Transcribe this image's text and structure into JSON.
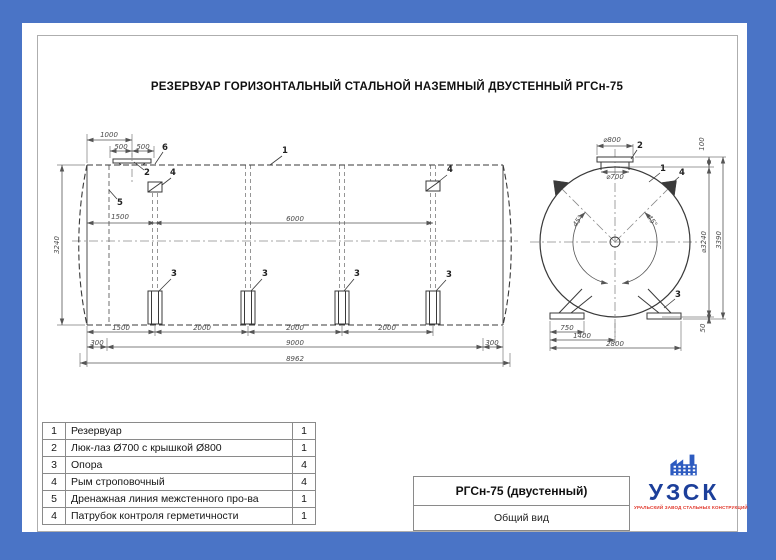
{
  "page": {
    "title": "РЕЗЕРВУАР ГОРИЗОНТАЛЬНЫЙ СТАЛЬНОЙ НАЗЕМНЫЙ ДВУСТЕННЫЙ РГСн-75"
  },
  "colors": {
    "border_blue": "#4a74c6",
    "logo_navy": "#1c3f9a",
    "logo_red": "#e03226",
    "line_dark": "#3a3a3a",
    "dim_gray": "#555555"
  },
  "parts_table": {
    "rows": [
      {
        "no": "1",
        "name": "Резервуар",
        "qty": "1"
      },
      {
        "no": "2",
        "name": "Люк-лаз Ø700 с крышкой Ø800",
        "qty": "1"
      },
      {
        "no": "3",
        "name": "Опора",
        "qty": "4"
      },
      {
        "no": "4",
        "name": "Рым строповочный",
        "qty": "4"
      },
      {
        "no": "5",
        "name": "Дренажная линия межстенного про-ва",
        "qty": "1"
      },
      {
        "no": "4",
        "name": "Патрубок контроля герметичности",
        "qty": "1"
      }
    ]
  },
  "title_block": {
    "model": "РГСн-75 (двустенный)",
    "view": "Общий вид"
  },
  "logo": {
    "name": "УЗСК",
    "tagline": "УРАЛЬСКИЙ ЗАВОД СТАЛЬНЫХ КОНСТРУКЦИЙ"
  },
  "drawing": {
    "labels": [
      {
        "t": "1000",
        "x": 87,
        "y": 112,
        "n": "dim-1000"
      },
      {
        "t": "500",
        "x": 99,
        "y": 124,
        "n": "dim-500-left"
      },
      {
        "t": "500",
        "x": 121,
        "y": 124,
        "n": "dim-500-right"
      },
      {
        "t": "1500",
        "x": 98,
        "y": 194,
        "n": "dim-1500-top"
      },
      {
        "t": "6000",
        "x": 273,
        "y": 196,
        "n": "dim-6000"
      },
      {
        "t": "3240",
        "x": 35,
        "y": 222,
        "r": -90,
        "n": "dim-3240-height"
      },
      {
        "t": "1500",
        "x": 99,
        "y": 305,
        "n": "dim-1500-bottom"
      },
      {
        "t": "2000",
        "x": 180,
        "y": 305,
        "n": "dim-2000-1"
      },
      {
        "t": "2000",
        "x": 273,
        "y": 305,
        "n": "dim-2000-2"
      },
      {
        "t": "2000",
        "x": 365,
        "y": 305,
        "n": "dim-2000-3"
      },
      {
        "t": "300",
        "x": 75,
        "y": 320,
        "n": "dim-300-left"
      },
      {
        "t": "9000",
        "x": 273,
        "y": 320,
        "n": "dim-9000"
      },
      {
        "t": "300",
        "x": 470,
        "y": 320,
        "n": "dim-300-right"
      },
      {
        "t": "8962",
        "x": 273,
        "y": 336,
        "n": "dim-8962"
      },
      {
        "t": "1",
        "x": 263,
        "y": 128,
        "c": 1,
        "n": "callout-1-shell"
      },
      {
        "t": "2",
        "x": 125,
        "y": 150,
        "c": 1,
        "n": "callout-2-manhole"
      },
      {
        "t": "6",
        "x": 143,
        "y": 125,
        "c": 1,
        "n": "callout-6-nozzle"
      },
      {
        "t": "4",
        "x": 151,
        "y": 150,
        "c": 1,
        "n": "callout-4-fitting-left"
      },
      {
        "t": "4",
        "x": 428,
        "y": 147,
        "c": 1,
        "n": "callout-4-fitting-right"
      },
      {
        "t": "5",
        "x": 98,
        "y": 180,
        "c": 1,
        "n": "callout-5-drain-line"
      },
      {
        "t": "3",
        "x": 152,
        "y": 251,
        "c": 1,
        "n": "callout-3-support-1"
      },
      {
        "t": "3",
        "x": 243,
        "y": 251,
        "c": 1,
        "n": "callout-3-support-2"
      },
      {
        "t": "3",
        "x": 335,
        "y": 251,
        "c": 1,
        "n": "callout-3-support-3"
      },
      {
        "t": "3",
        "x": 427,
        "y": 252,
        "c": 1,
        "n": "callout-3-support-4"
      },
      {
        "t": "⌀800",
        "x": 590,
        "y": 117,
        "n": "dim-d800"
      },
      {
        "t": "⌀700",
        "x": 593,
        "y": 154,
        "n": "dim-d700"
      },
      {
        "t": "100",
        "x": 680,
        "y": 121,
        "r": -90,
        "n": "dim-100"
      },
      {
        "t": "⌀3240",
        "x": 682,
        "y": 219,
        "r": -90,
        "n": "dim-d3240"
      },
      {
        "t": "3390",
        "x": 697,
        "y": 217,
        "r": -90,
        "n": "dim-3390"
      },
      {
        "t": "50",
        "x": 681,
        "y": 305,
        "r": -90,
        "n": "dim-50"
      },
      {
        "t": "45°",
        "x": 556,
        "y": 198,
        "r": -55,
        "n": "dim-45-left"
      },
      {
        "t": "45°",
        "x": 630,
        "y": 198,
        "r": 55,
        "n": "dim-45-right"
      },
      {
        "t": "750",
        "x": 545,
        "y": 305,
        "n": "dim-750"
      },
      {
        "t": "1400",
        "x": 560,
        "y": 313,
        "n": "dim-1400"
      },
      {
        "t": "2800",
        "x": 593,
        "y": 321,
        "n": "dim-2800"
      },
      {
        "t": "2",
        "x": 618,
        "y": 123,
        "c": 1,
        "n": "callout-2-end-cover"
      },
      {
        "t": "1",
        "x": 641,
        "y": 146,
        "c": 1,
        "n": "callout-1-end-shell"
      },
      {
        "t": "4",
        "x": 660,
        "y": 150,
        "c": 1,
        "n": "callout-4-end-lug"
      },
      {
        "t": "3",
        "x": 656,
        "y": 272,
        "c": 1,
        "n": "callout-3-end-support"
      }
    ]
  }
}
